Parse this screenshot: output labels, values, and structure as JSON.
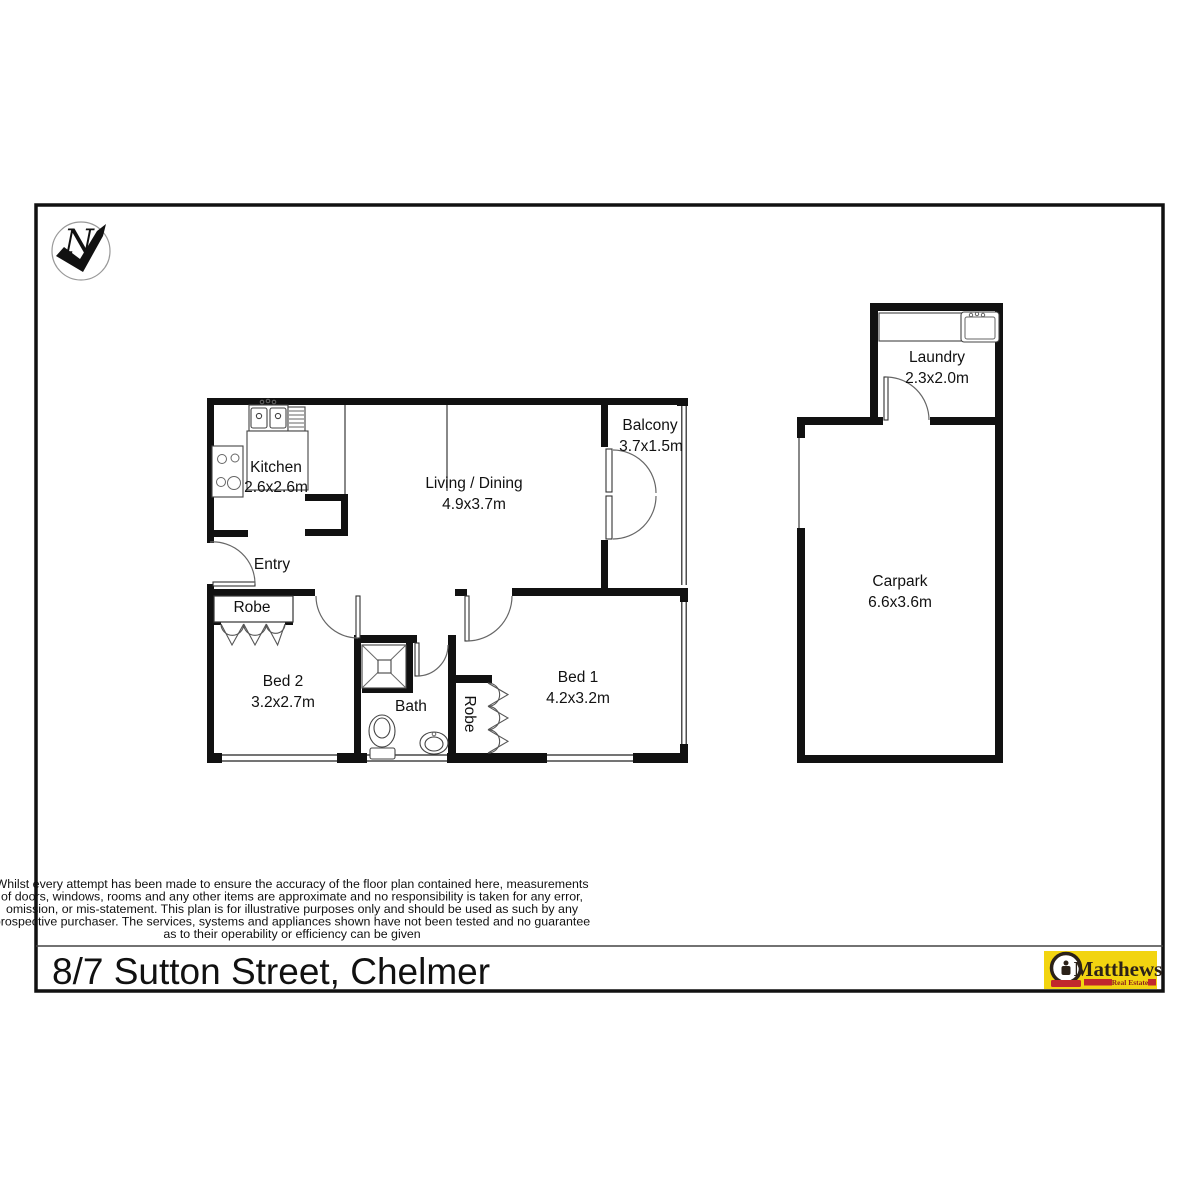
{
  "north": {
    "label": "N"
  },
  "rooms": {
    "kitchen": {
      "name": "Kitchen",
      "dims": "2.6x2.6m"
    },
    "living": {
      "name": "Living / Dining",
      "dims": "4.9x3.7m"
    },
    "balcony": {
      "name": "Balcony",
      "dims": "3.7x1.5m"
    },
    "entry": {
      "name": "Entry"
    },
    "robe_bed2": {
      "name": "Robe"
    },
    "bed2": {
      "name": "Bed 2",
      "dims": "3.2x2.7m"
    },
    "bath": {
      "name": "Bath"
    },
    "robe_bed1": {
      "name": "Robe"
    },
    "bed1": {
      "name": "Bed 1",
      "dims": "4.2x3.2m"
    },
    "laundry": {
      "name": "Laundry",
      "dims": "2.3x2.0m"
    },
    "carpark": {
      "name": "Carpark",
      "dims": "6.6x3.6m"
    }
  },
  "disclaimer": {
    "lines": [
      "Whilst every attempt has been made to ensure the accuracy of the floor plan contained here, measurements",
      "of doors, windows, rooms and any other items are approximate and no responsibility is taken for any error,",
      "omission, or mis-statement. This plan is for illustrative purposes only and should be used as such by any",
      "prospective purchaser. The services, systems and appliances shown have not been tested and no guarantee",
      "as to their operability or efficiency can be given"
    ]
  },
  "footer": {
    "address": "8/7 Sutton Street, Chelmer"
  },
  "logo": {
    "brand": "Matthews",
    "tagline": "Real Estate",
    "colors": {
      "bg": "#f2d410",
      "red": "#c1272d",
      "ink": "#2b2118"
    }
  }
}
